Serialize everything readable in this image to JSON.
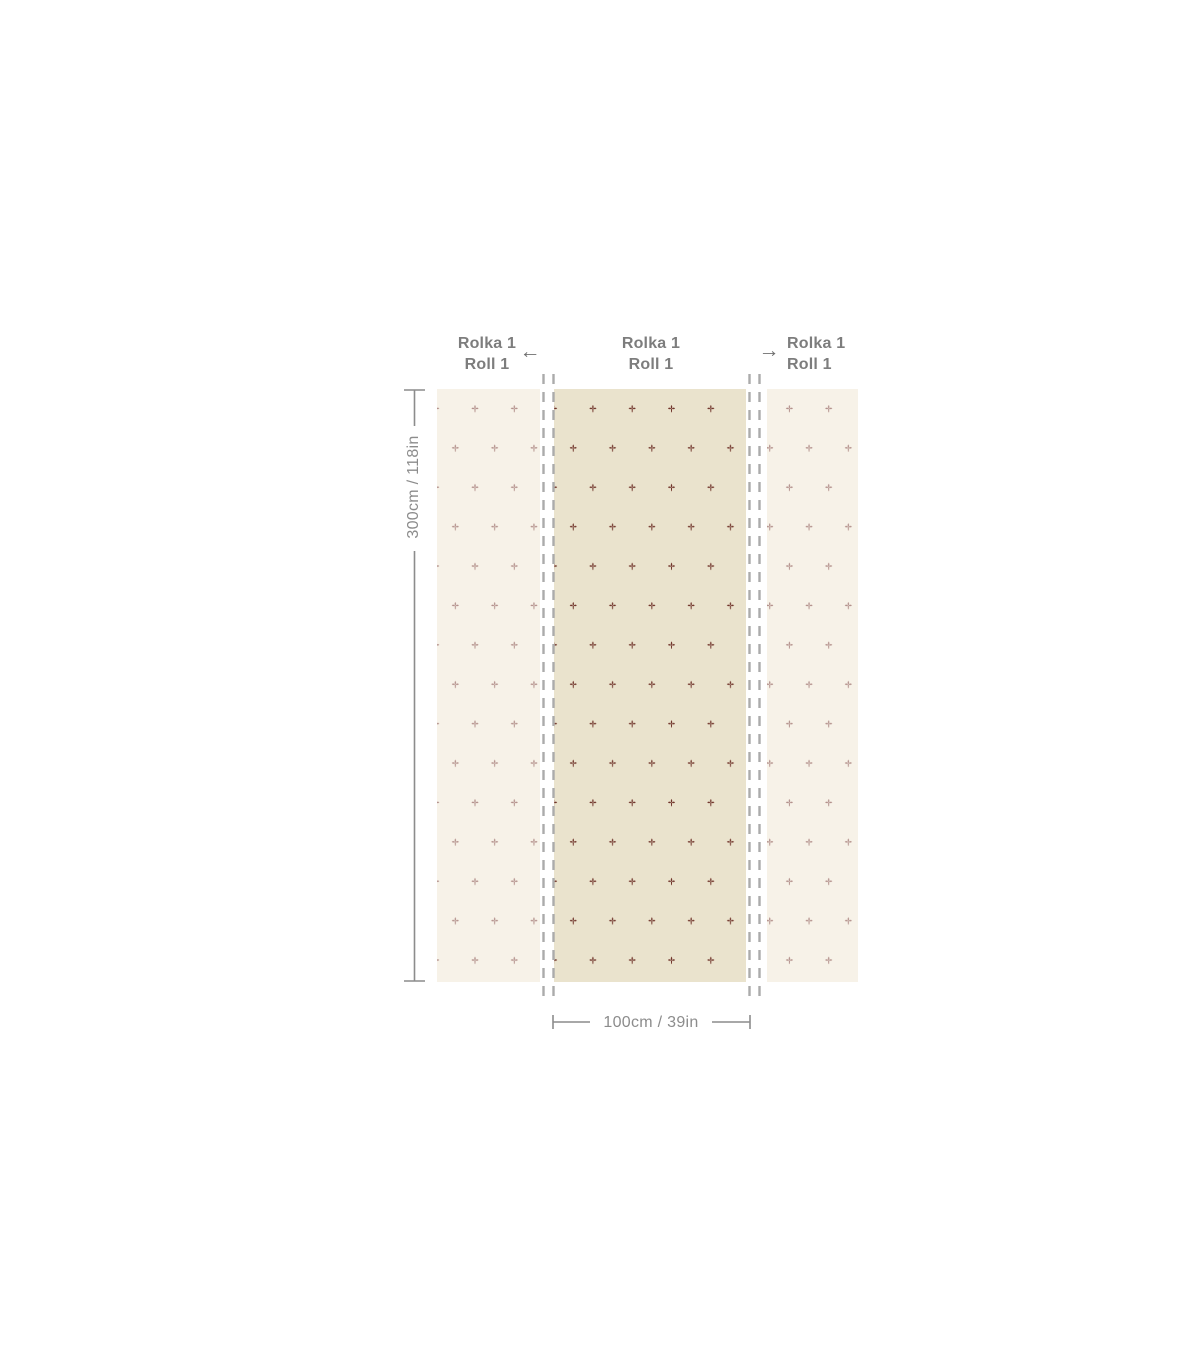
{
  "diagram_title": "wallpaper-roll-size-diagram",
  "roll_labels": [
    {
      "line1": "Rolka 1",
      "line2": "Roll 1"
    },
    {
      "line1": "Rolka 1",
      "line2": "Roll 1"
    },
    {
      "line1": "Rolka 1",
      "line2": "Roll 1"
    }
  ],
  "arrows": {
    "left": "←",
    "right": "→"
  },
  "dimensions": {
    "height_label": "300cm / 118in",
    "width_label": "100cm / 39in"
  },
  "colors": {
    "page_bg": "#ffffff",
    "side_panel": "#f7f2e8",
    "center_panel": "#eae3cd",
    "motif_strong": "#6f3329",
    "motif_muted": "#b28f8a",
    "cut_line": "#ababab",
    "dim_line": "#8c8c8c",
    "dim_text": "#8c8c8c",
    "label_text": "#7d7d7d",
    "arrow": "#707070"
  }
}
